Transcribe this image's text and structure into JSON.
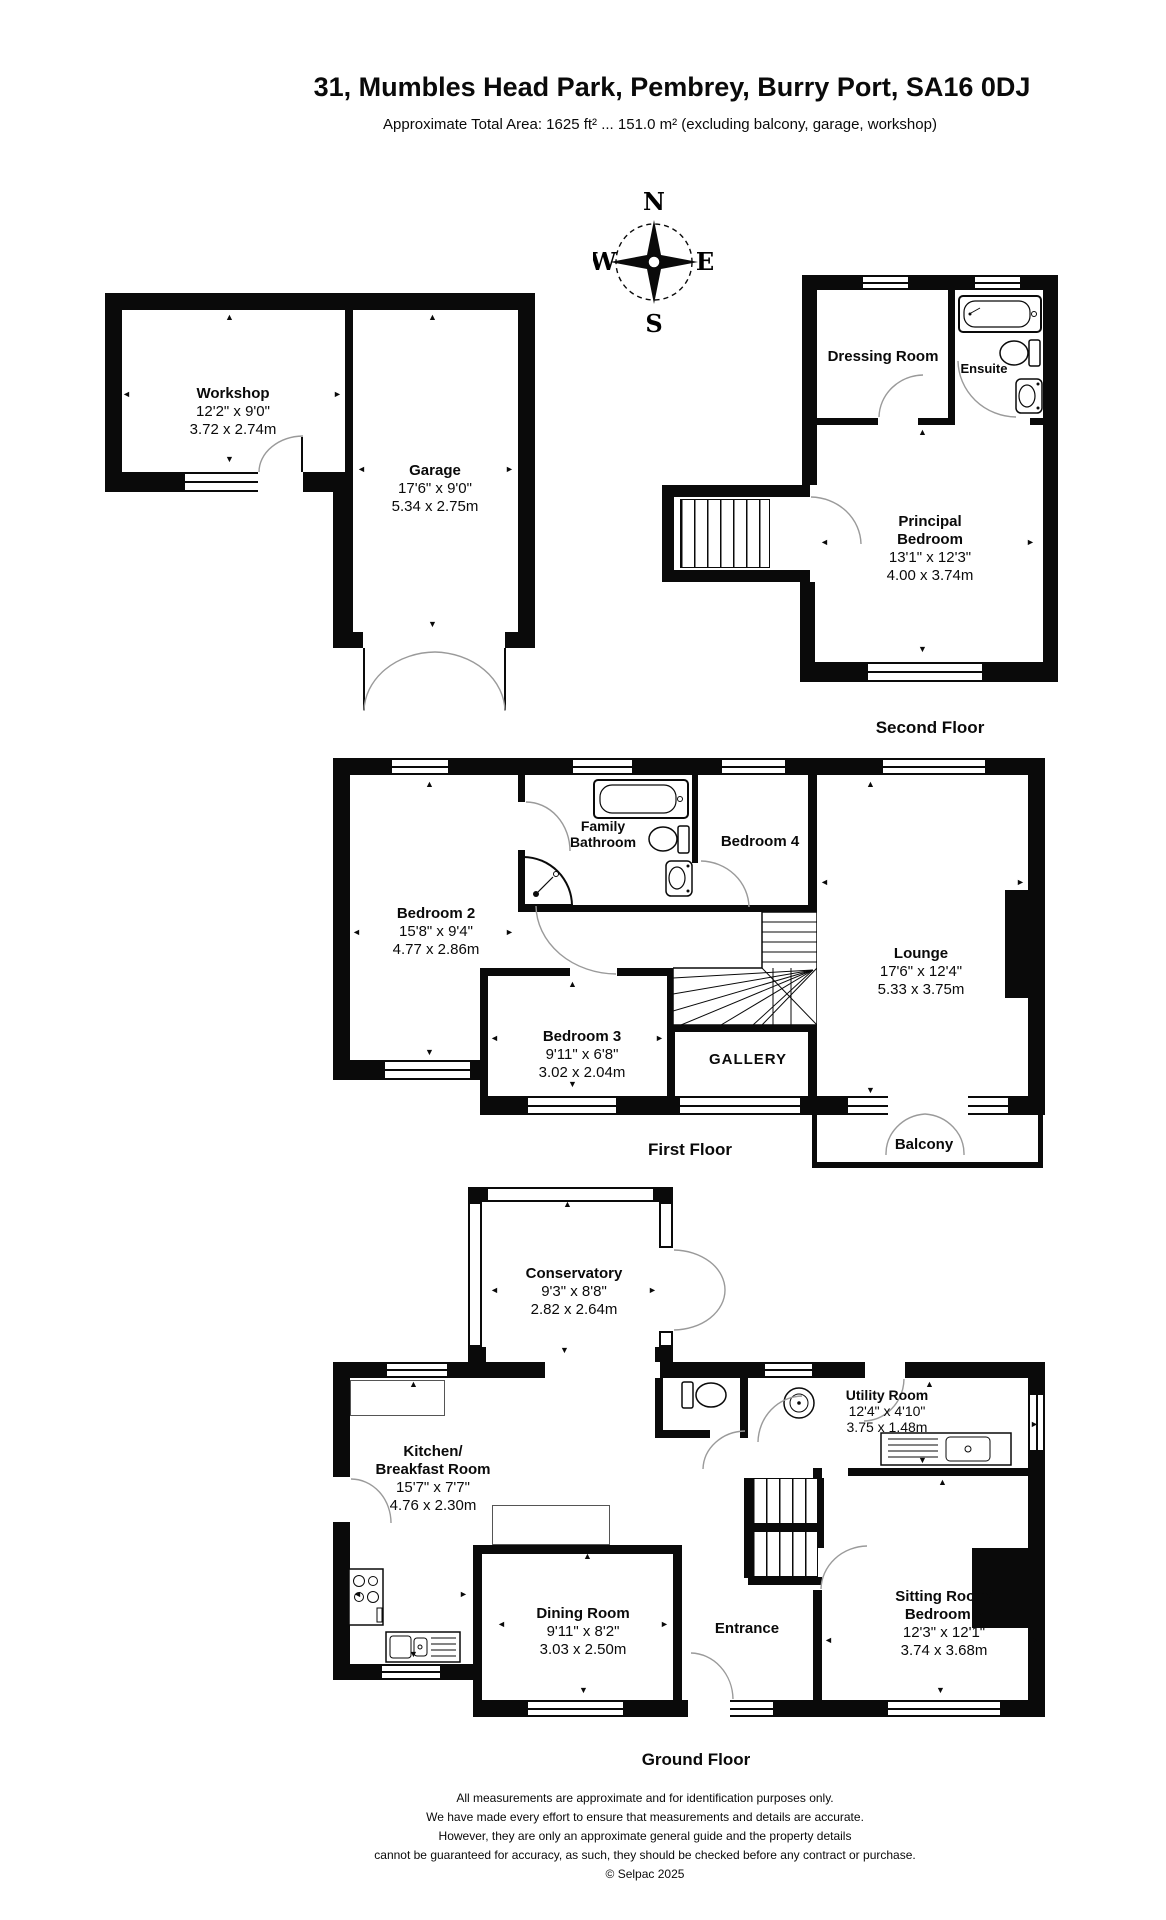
{
  "title": "31, Mumbles Head Park, Pembrey, Burry Port, SA16 0DJ",
  "subtitle": "Approximate Total Area: 1625 ft² ... 151.0 m² (excluding balcony, garage, workshop)",
  "compass": {
    "n": "N",
    "e": "E",
    "s": "S",
    "w": "W"
  },
  "floors": {
    "second": "Second Floor",
    "first": "First Floor",
    "ground": "Ground Floor"
  },
  "icons": {
    "up": "▲",
    "down": "▼",
    "left": "◄",
    "right": "►"
  },
  "rooms": {
    "workshop": {
      "name": "Workshop",
      "dim_ft": "12'2\" x 9'0\"",
      "dim_m": "3.72 x 2.74m"
    },
    "garage": {
      "name": "Garage",
      "dim_ft": "17'6\" x 9'0\"",
      "dim_m": "5.34 x 2.75m"
    },
    "dressing": {
      "name": "Dressing Room"
    },
    "ensuite": {
      "name": "Ensuite"
    },
    "principal": {
      "name1": "Principal",
      "name2": "Bedroom",
      "dim_ft": "13'1\" x 12'3\"",
      "dim_m": "4.00 x 3.74m"
    },
    "bedroom2": {
      "name": "Bedroom 2",
      "dim_ft": "15'8\" x 9'4\"",
      "dim_m": "4.77 x 2.86m"
    },
    "bathroom": {
      "name1": "Family",
      "name2": "Bathroom"
    },
    "bedroom4": {
      "name": "Bedroom 4"
    },
    "lounge": {
      "name": "Lounge",
      "dim_ft": "17'6\" x 12'4\"",
      "dim_m": "5.33 x 3.75m"
    },
    "bedroom3": {
      "name": "Bedroom 3",
      "dim_ft": "9'11\" x 6'8\"",
      "dim_m": "3.02 x 2.04m"
    },
    "gallery": {
      "name": "GALLERY"
    },
    "balcony": {
      "name": "Balcony"
    },
    "conservatory": {
      "name": "Conservatory",
      "dim_ft": "9'3\" x 8'8\"",
      "dim_m": "2.82 x 2.64m"
    },
    "kitchen": {
      "name1": "Kitchen/",
      "name2": "Breakfast Room",
      "dim_ft": "15'7\" x 7'7\"",
      "dim_m": "4.76 x 2.30m"
    },
    "utility": {
      "name": "Utility Room",
      "dim_ft": "12'4\" x 4'10\"",
      "dim_m": "3.75 x 1.48m"
    },
    "dining": {
      "name": "Dining Room",
      "dim_ft": "9'11\" x 8'2\"",
      "dim_m": "3.03 x 2.50m"
    },
    "entrance": {
      "name": "Entrance"
    },
    "sitting": {
      "name1": "Sitting Room/",
      "name2": "Bedroom 5",
      "dim_ft": "12'3\" x 12'1\"",
      "dim_m": "3.74 x 3.68m"
    }
  },
  "disclaimer": [
    "All measurements are approximate and for identification purposes only.",
    "We have made every effort to ensure that measurements and details are accurate.",
    "However, they are only an approximate general guide and the property details",
    "cannot be guaranteed for accuracy, as such, they should be checked before any contract or purchase.",
    "© Selpac 2025"
  ]
}
